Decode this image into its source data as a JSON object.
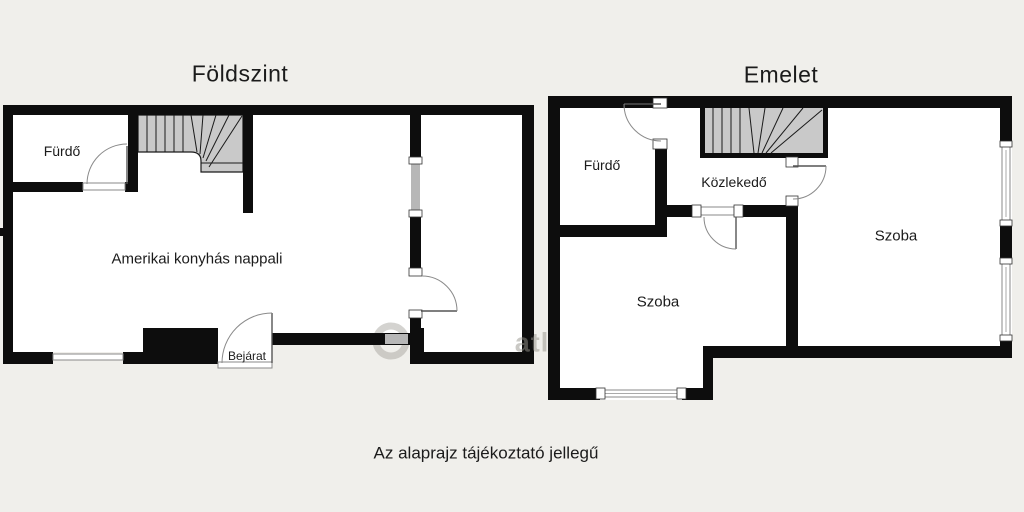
{
  "ground_floor": {
    "title": "Földszint",
    "bathroom": "Fürdő",
    "living_room": "Amerikai konyhás nappali",
    "entrance": "Bejárat"
  },
  "upper_floor": {
    "title": "Emelet",
    "bathroom": "Fürdő",
    "hallway": "Közlekedő",
    "room_right": "Szoba",
    "room_lower": "Szoba"
  },
  "caption": "Az alaprajz tájékoztató jellegű",
  "watermark_fragment": "atl",
  "colors": {
    "background": "#f0efeb",
    "walls": "#0d0d0d",
    "stairs_fill": "#c9c9c9",
    "window_fill": "#b7b7b7",
    "door_arc": "#8a8a8a"
  }
}
